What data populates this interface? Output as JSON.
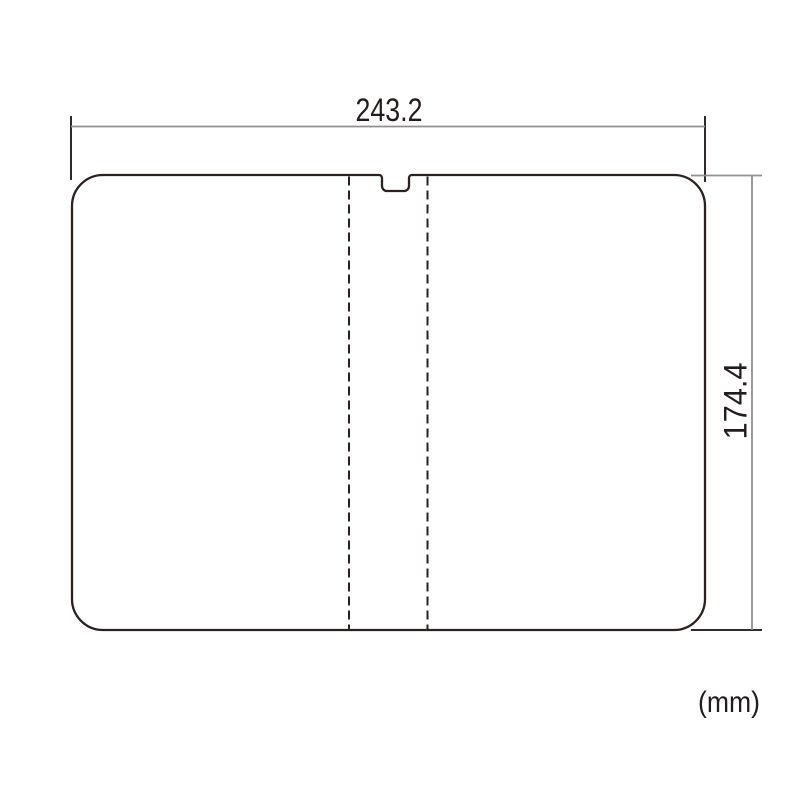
{
  "drawing": {
    "name": "screen-protector-dimension-diagram",
    "width_dimension_label": "243.2",
    "height_dimension_label": "174.4",
    "unit_label": "(mm)",
    "shape": {
      "type": "rounded-rectangle-with-top-notch",
      "fold_lines": "two vertical dashed lines flanking center notch"
    },
    "colors": {
      "background": "#ffffff",
      "outline": "#2b2220",
      "dashed_line": "#2b2220",
      "dimension_line": "#8f8f8f",
      "extension_line": "#302b29",
      "label_text": "#221d1b"
    }
  }
}
